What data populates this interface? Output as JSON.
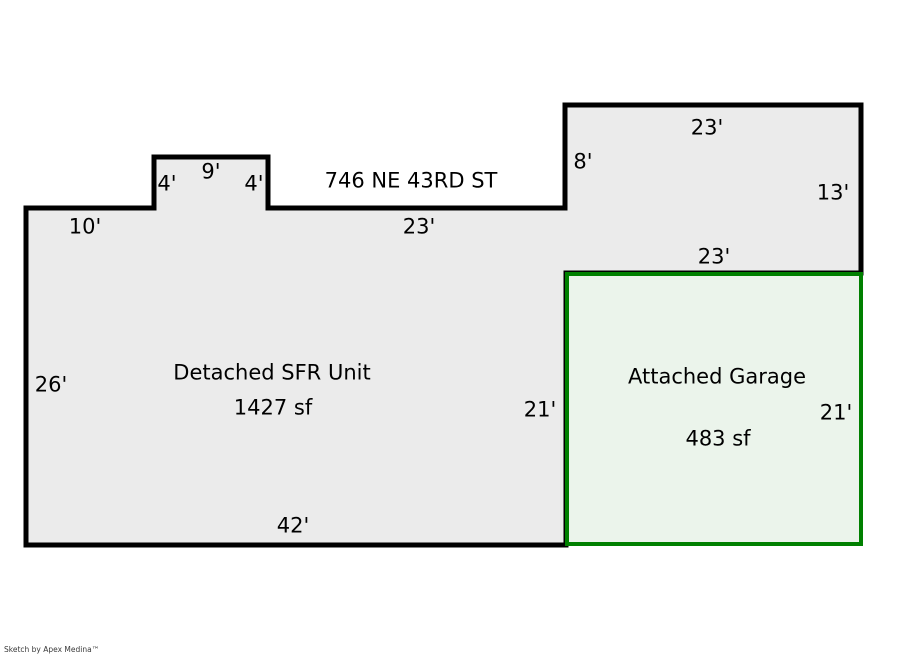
{
  "sketch": {
    "address": "746 NE 43RD ST",
    "units": {
      "sfr": {
        "name": "Detached SFR Unit",
        "area": "1427 sf"
      },
      "garage": {
        "name": "Attached Garage",
        "area": "483 sf"
      }
    },
    "dims": {
      "top_left_10": "10'",
      "bump_left_4": "4'",
      "bump_top_9": "9'",
      "bump_right_4": "4'",
      "main_top_23": "23'",
      "step_left_8": "8'",
      "upper_top_23": "23'",
      "upper_right_13": "13'",
      "garage_top_23": "23'",
      "left_26": "26'",
      "sfr_right_21": "21'",
      "garage_right_21": "21'",
      "bottom_42": "42'"
    },
    "colors": {
      "unit_fill": "#ebebeb",
      "unit_stroke": "#000000",
      "garage_fill": "#ebf4eb",
      "garage_stroke": "#008000"
    }
  },
  "footer": {
    "credit": "Sketch by Apex Medina™"
  }
}
